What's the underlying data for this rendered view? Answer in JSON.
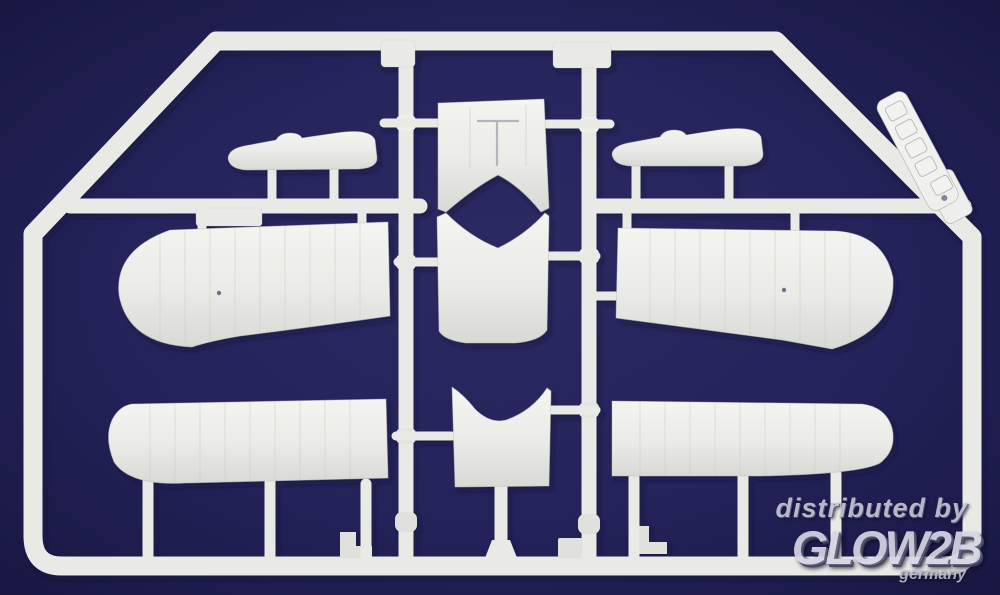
{
  "scene": {
    "background_color": "#232259",
    "plastic_color": "#e9e9e5",
    "plastic_shadow_color": "#b9b9c3",
    "plastic_highlight_color": "#f5f5f1"
  },
  "watermark": {
    "distributed_by": "distributed by",
    "brand": "GLOW2B",
    "country": "germany",
    "color": "#c9c9d8"
  }
}
